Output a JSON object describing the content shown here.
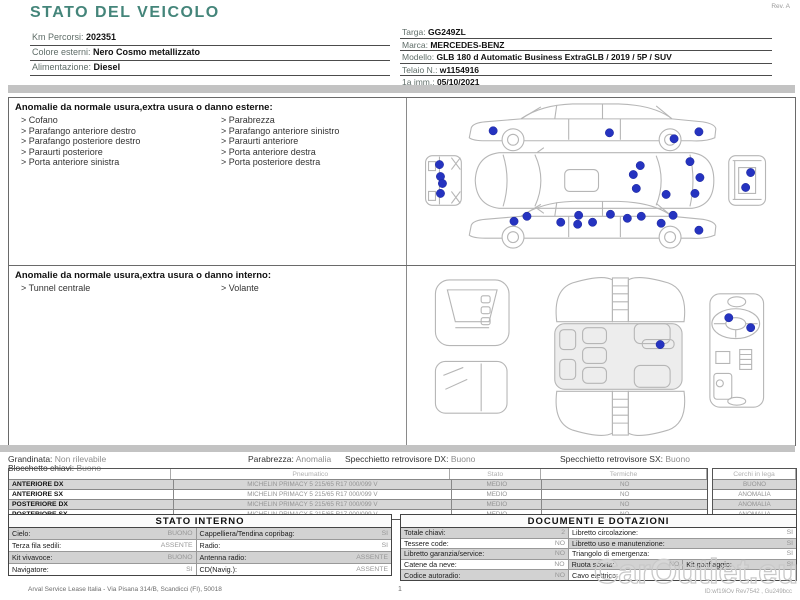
{
  "meta": {
    "rev": "Rev. A"
  },
  "header": {
    "title": "STATO DEL VEICOLO",
    "left_fields": [
      {
        "label": "Km Percorsi: ",
        "value": "202351"
      },
      {
        "label": "Colore esterni: ",
        "value": "Nero Cosmo metallizzato"
      },
      {
        "label": "Alimentazione: ",
        "value": "Diesel"
      }
    ],
    "right_fields": [
      {
        "label": "Targa: ",
        "value": "GG249ZL"
      },
      {
        "label": "Marca: ",
        "value": "MERCEDES-BENZ"
      },
      {
        "label": "Modello: ",
        "value": "GLB 180 d Automatic Business ExtraGLB / 2019 / 5P / SUV"
      },
      {
        "label": "Telaio N.: ",
        "value": "w1154916"
      },
      {
        "label": "1a imm.: ",
        "value": "05/10/2021"
      }
    ]
  },
  "exterior": {
    "heading": "Anomalie da normale usura,extra usura o danno esterne:",
    "items_left": [
      "Cofano",
      "Parafango anteriore destro",
      "Parafango posteriore destro",
      "Paraurti posteriore",
      "Porta anteriore sinistra"
    ],
    "items_right": [
      "Parabrezza",
      "Parafango anteriore sinistro",
      "Paraurti anteriore",
      "Porta anteriore destra",
      "Porta posteriore destra"
    ],
    "damage_dots": [
      [
        86,
        33
      ],
      [
        203,
        35
      ],
      [
        268,
        41
      ],
      [
        293,
        34
      ],
      [
        234,
        68
      ],
      [
        227,
        77
      ],
      [
        284,
        64
      ],
      [
        294,
        80
      ],
      [
        230,
        91
      ],
      [
        260,
        97
      ],
      [
        289,
        96
      ],
      [
        32,
        67
      ],
      [
        33,
        79
      ],
      [
        35,
        86
      ],
      [
        33,
        96
      ],
      [
        345,
        75
      ],
      [
        340,
        90
      ],
      [
        107,
        124
      ],
      [
        120,
        119
      ],
      [
        154,
        125
      ],
      [
        171,
        127
      ],
      [
        172,
        118
      ],
      [
        186,
        125
      ],
      [
        204,
        117
      ],
      [
        221,
        121
      ],
      [
        235,
        119
      ],
      [
        255,
        126
      ],
      [
        267,
        118
      ],
      [
        293,
        133
      ]
    ]
  },
  "interior": {
    "heading": "Anomalie da normale usura,extra usura o danno interno:",
    "items_left": [
      "Tunnel centrale"
    ],
    "items_right": [
      "Volante"
    ],
    "damage_dots": [
      [
        254,
        79
      ],
      [
        323,
        52
      ],
      [
        345,
        62
      ]
    ]
  },
  "summary": {
    "fields": [
      {
        "label": "Grandinata: ",
        "value": "Non rilevabile"
      },
      {
        "label": "Parabrezza: ",
        "value": "Anomalia"
      },
      {
        "label": "Specchietto retrovisore DX: ",
        "value": "Buono"
      },
      {
        "label": "Specchietto retrovisore SX: ",
        "value": "Buono"
      }
    ],
    "second_line": {
      "label": "Blocchetto chiavi: ",
      "value": "Buono"
    }
  },
  "tyres": {
    "col_headers": [
      "Pneumatico",
      "Stato",
      "Termiche",
      "Cerchi in lega"
    ],
    "rows": [
      {
        "position": "ANTERIORE DX",
        "tyre": "MICHELIN  PRIMACY 5 215/65 R17 000/099 V",
        "stato": "MEDIO",
        "termiche": "NO",
        "cerchi": "BUONO"
      },
      {
        "position": "ANTERIORE SX",
        "tyre": "MICHELIN  PRIMACY 5 215/65 R17 000/099 V",
        "stato": "MEDIO",
        "termiche": "NO",
        "cerchi": "ANOMALIA"
      },
      {
        "position": "POSTERIORE DX",
        "tyre": "MICHELIN  PRIMACY 5 215/65 R17 000/099 V",
        "stato": "MEDIO",
        "termiche": "NO",
        "cerchi": "ANOMALIA"
      },
      {
        "position": "POSTERIORE SX",
        "tyre": "MICHELIN  PRIMACY 5 215/65 R17 000/099 V",
        "stato": "MEDIO",
        "termiche": "NO",
        "cerchi": "ANOMALIA"
      }
    ]
  },
  "stato_interno": {
    "title": "STATO INTERNO",
    "rows": [
      [
        {
          "label": "Cielo:",
          "value": "BUONO"
        },
        {
          "label": "Cappelliera/Tendina copribag:",
          "value": "SI"
        }
      ],
      [
        {
          "label": "Terza fila sedili:",
          "value": "ASSENTE"
        },
        {
          "label": "Radio:",
          "value": "SI"
        }
      ],
      [
        {
          "label": "Kit vivavoce:",
          "value": "BUONO"
        },
        {
          "label": "Antenna radio:",
          "value": "ASSENTE"
        }
      ],
      [
        {
          "label": "Navigatore:",
          "value": "SI"
        },
        {
          "label": "CD(Navig.):",
          "value": "ASSENTE"
        }
      ]
    ]
  },
  "documenti": {
    "title": "DOCUMENTI E DOTAZIONI",
    "rows": [
      [
        {
          "label": "Totale chiavi:",
          "value": "2"
        },
        {
          "label": "Libretto circolazione:",
          "value": "SI"
        }
      ],
      [
        {
          "label": "Tessere code:",
          "value": "NO"
        },
        {
          "label": "Libretto uso e manutenzione:",
          "value": "SI"
        }
      ],
      [
        {
          "label": "Libretto garanzia/service:",
          "value": "NO"
        },
        {
          "label": "Triangolo di emergenza:",
          "value": "SI"
        }
      ],
      [
        {
          "label": "Catene da neve:",
          "value": "NO"
        },
        {
          "label": "Ruota scorta:",
          "value": "NO"
        },
        {
          "label": "Kit gonfiaggio:",
          "value": "SI"
        }
      ],
      [
        {
          "label": "Codice autoradio:",
          "value": "NO"
        },
        {
          "label": "Cavo elettrico:",
          "value": ""
        }
      ]
    ]
  },
  "footer": {
    "company": "Arval Service Lease Italia - Via Pisana 314/B, Scandicci (FI), 50018",
    "page_number": "1",
    "doc_id": "ID:wf19iOv Rev7542 , Gu249bcc",
    "watermark": "CarOutlet.eu"
  },
  "colors": {
    "accent_teal": "#44857a",
    "damage_dot_blue": "#2533c0",
    "row_gray": "#d2d2d2"
  }
}
